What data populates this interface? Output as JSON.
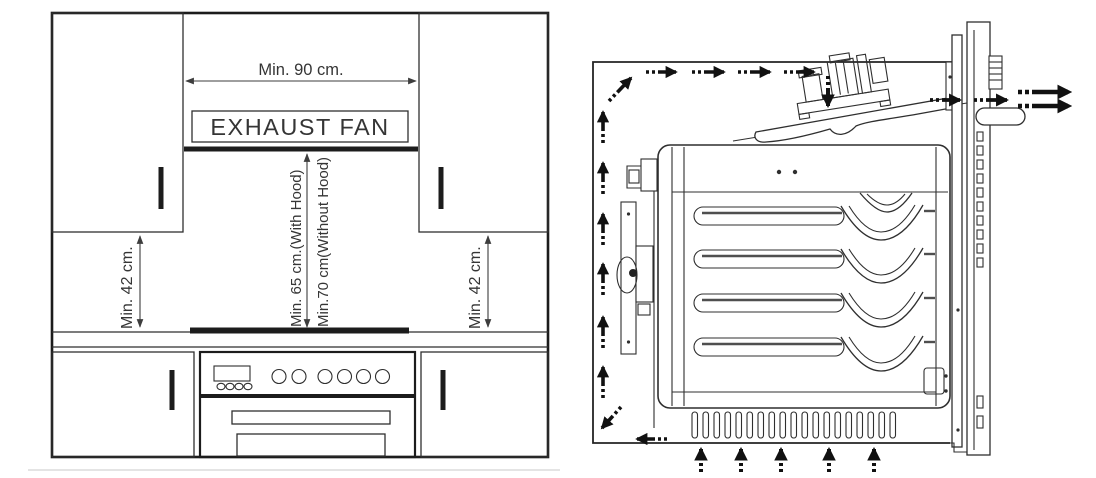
{
  "page": {
    "background": "#ffffff"
  },
  "palette": {
    "line": "#2f2f2f",
    "heavy_line": "#1c1c1c",
    "shade_line": "#4f4f4f",
    "arrow": "#111111",
    "dimension": "#3d3d3d",
    "text": "#353535",
    "divider": "#d9d9d9"
  },
  "installation_diagram": {
    "exhaust_fan_label": "EXHAUST FAN",
    "min_width_label": "Min. 90 cm.",
    "with_hood_label": "Min. 65 cm.(With Hood)",
    "without_hood_label": "Min.70 cm(Without Hood)",
    "left_clearance_label": "Min. 42 cm.",
    "right_clearance_label": "Min. 42 cm."
  },
  "airflow_diagram": {
    "arrow_icons": [
      "airflow-arrow-up",
      "airflow-arrow-right",
      "airflow-arrow-down",
      "airflow-arrow-left",
      "airflow-arrow-exit"
    ]
  }
}
